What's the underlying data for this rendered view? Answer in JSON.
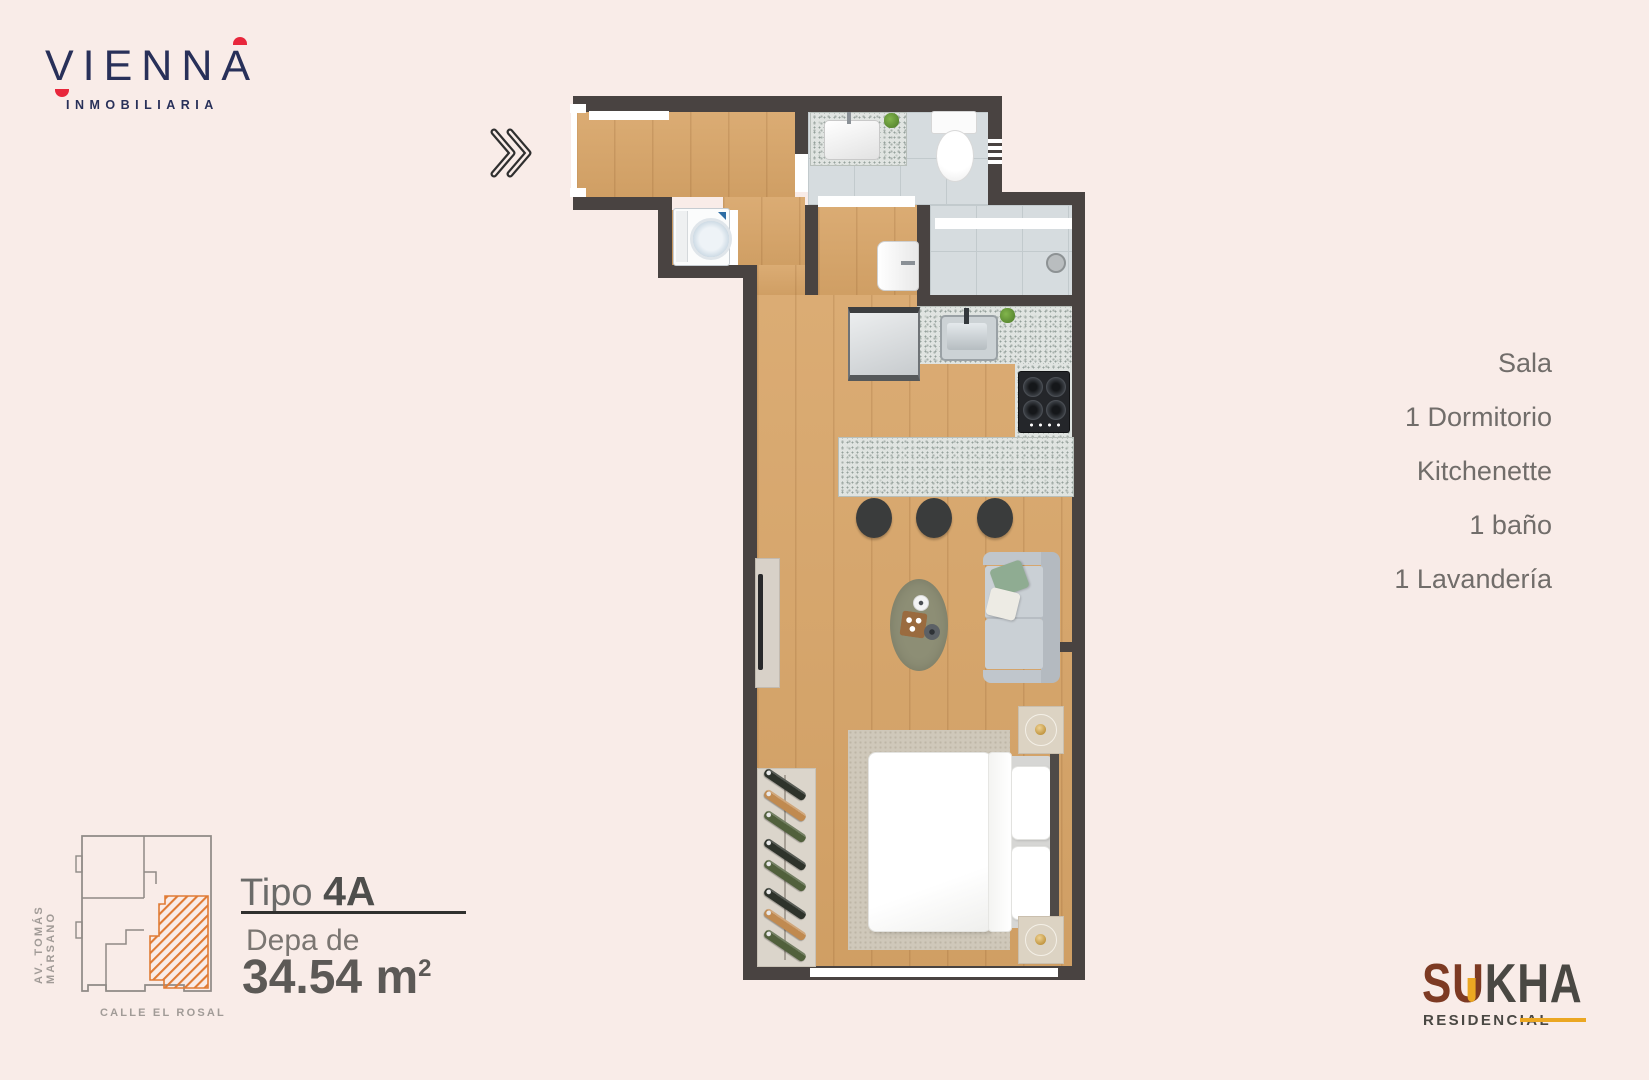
{
  "page": {
    "background": "#f9ece8"
  },
  "brand": {
    "name": "VIENNA",
    "tagline": "INMOBILIARIA",
    "color_navy": "#283059",
    "color_red": "#e8273c"
  },
  "icons": {
    "next": "double-chevron-right"
  },
  "features": {
    "items": [
      "Sala",
      "1 Dormitorio",
      "Kitchenette",
      "1 baño",
      "1 Lavandería"
    ]
  },
  "unit": {
    "type_label": "Tipo",
    "type_value": "4A",
    "area_label": "Depa de",
    "area_value": "34.54 m",
    "area_sup": "2"
  },
  "site_map": {
    "street_left": "AV. TOMÁS MARSANO",
    "street_bottom": "CALLE EL ROSAL",
    "highlight_color": "#e07b35"
  },
  "developer": {
    "word_part1": "SU",
    "word_part2": "KHA",
    "subtitle": "RESIDENCIAL",
    "color_rust": "#7d3a23",
    "color_dark": "#4a4843",
    "color_gold": "#eba722"
  },
  "floorplan": {
    "wall_color": "#494341",
    "wood_color": "#d8a568",
    "tile_color": "#d6dcdf",
    "granite_color": "#e0e4e1"
  }
}
